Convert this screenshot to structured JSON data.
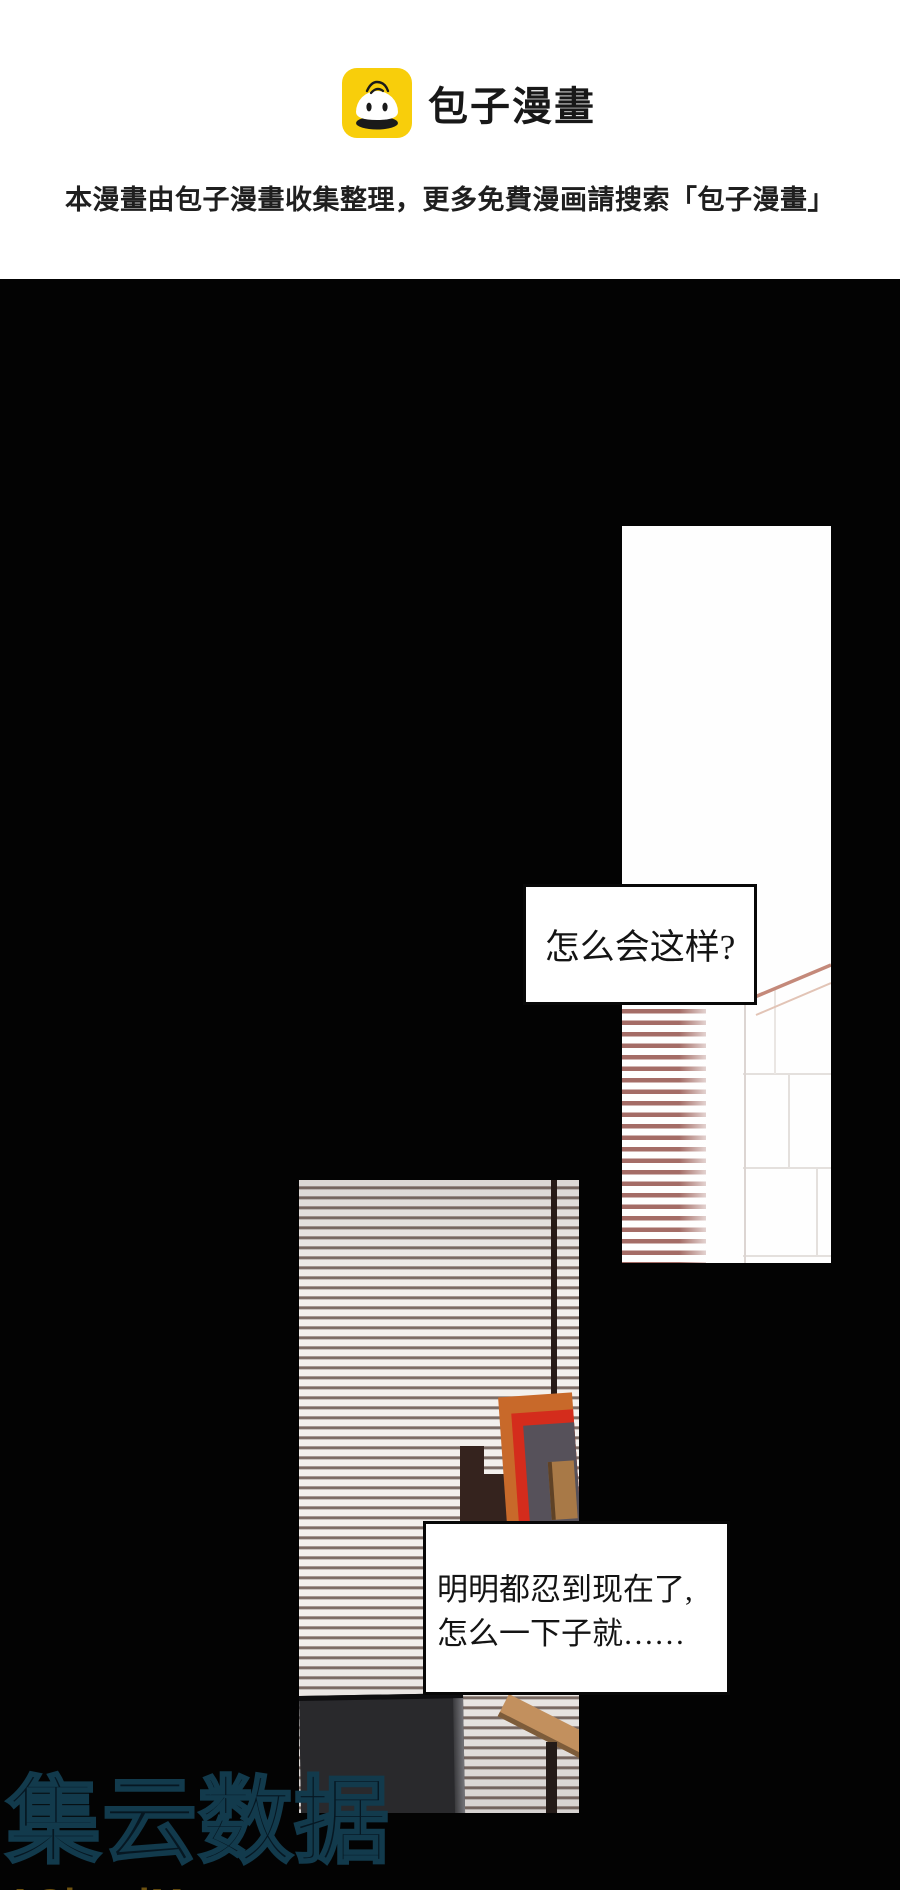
{
  "header": {
    "brand": "包子漫畫",
    "notice": "本漫畫由包子漫畫收集整理，更多免費漫画請搜索「包子漫畫」"
  },
  "speech": {
    "bubble1": "怎么会这样?",
    "bubble2_line1": "明明都忍到现在了,",
    "bubble2_line2": "怎么一下子就……"
  },
  "watermark": {
    "name": "集云数据",
    "site": "ACloudMerge.com"
  },
  "colors": {
    "brand_yellow": "#F8CE0B",
    "page_black": "#030303",
    "panel1_blinds_red": "#A46C66",
    "panel2_blinds_gray": "#6F5F58",
    "frame_orange": "#C8692A",
    "frame_red": "#D42C1C",
    "monitor_dark": "#29292C",
    "watermark_outline_blue": "#123A4C",
    "watermark_gold": "#6E5210"
  }
}
